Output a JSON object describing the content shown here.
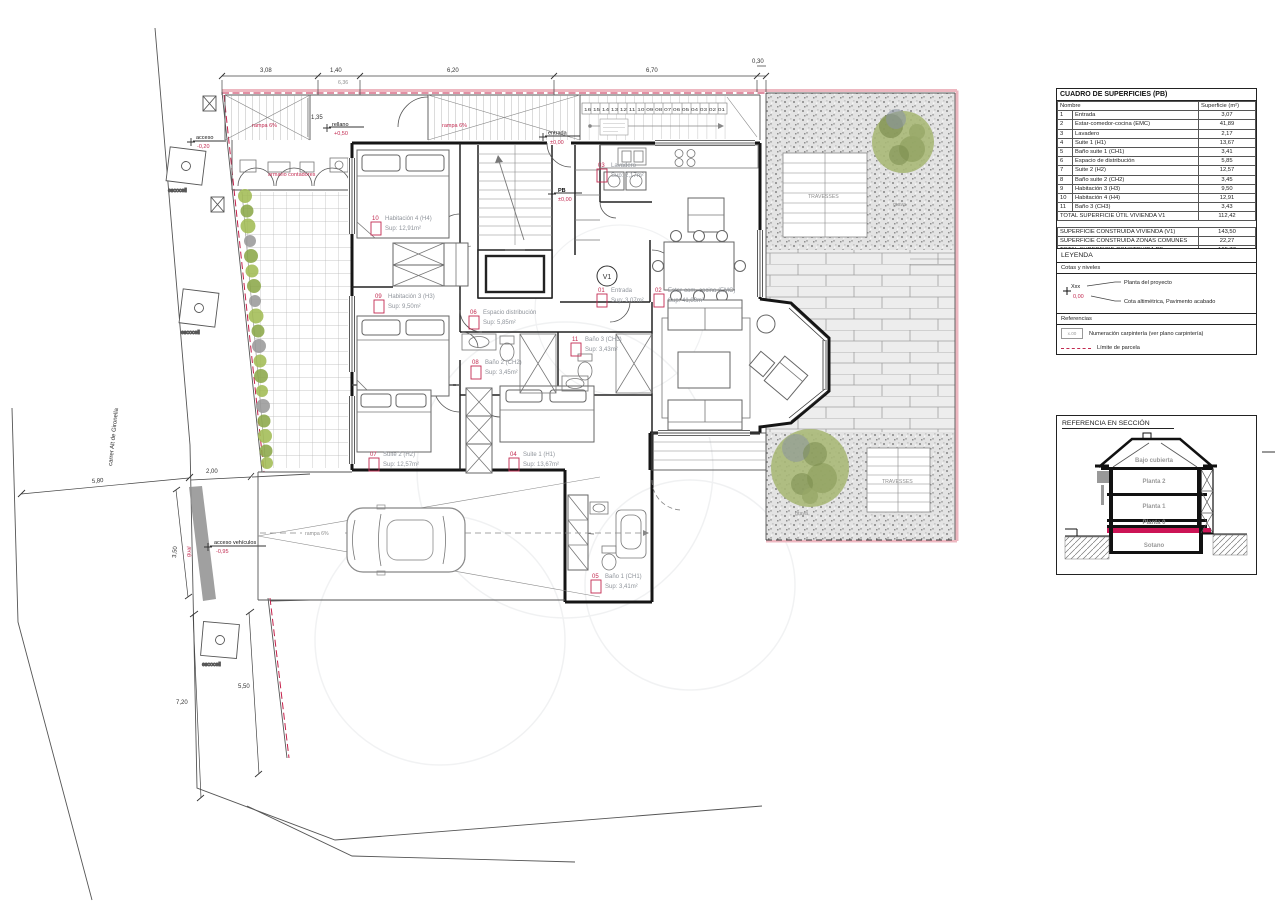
{
  "drawing": {
    "street_name": "carrer Alt de Gironella",
    "top_dims": {
      "d1": "3,08",
      "d2": "1,40",
      "d3": "6,20",
      "d4": "6,70",
      "d5": "0,30",
      "landing": "1,35",
      "offset": "6,36"
    },
    "site_dims": {
      "street_width": "5,80",
      "patio": "2,00",
      "gual_length": "3,50",
      "street_lower": "7,20",
      "kerb_lower": "5,50"
    },
    "levels": {
      "acceso": {
        "label": "acceso",
        "value": "-0,20"
      },
      "rellano": {
        "label": "rellano",
        "value": "+0,50"
      },
      "entrada": {
        "label": "entrada",
        "value": "±0,00"
      },
      "pb": {
        "label": "PB",
        "value": "±0,00"
      },
      "vehiculos": {
        "label": "acceso vehículos",
        "value": "-0,95"
      },
      "jardin": {
        "label": "jardín",
        "value": "+0,20"
      }
    },
    "notes": {
      "ramp_top_1": "rampa 6%",
      "ramp_top_2": "rampa 6%",
      "ramp_garage": "rampa 6%",
      "meter_cabinet": "armario contadores",
      "kerb": "gual",
      "deck_top": "TRAVESSES",
      "deck_bottom": "TRAVESSES",
      "gravel_top": "grava",
      "gravel_bottom": "grava",
      "tree_pit_1": "escocell",
      "tree_pit_2": "escocell",
      "tree_pit_3": "escocell",
      "stair_numbers": "16 15 14 13 12 11 10 09 08 07 06 05 04 03 02 01",
      "dwelling_tag": "V1"
    },
    "rooms": [
      {
        "num": "10",
        "name": "Habitación 4 (H4)",
        "area": "Sup: 12,91m²"
      },
      {
        "num": "09",
        "name": "Habitación 3 (H3)",
        "area": "Sup: 9,50m²"
      },
      {
        "num": "07",
        "name": "Suite 2 (H2)",
        "area": "Sup: 12,57m²"
      },
      {
        "num": "04",
        "name": "Suite 1 (H1)",
        "area": "Sup: 13,67m²"
      },
      {
        "num": "06",
        "name": "Espacio distribución",
        "area": "Sup: 5,85m²"
      },
      {
        "num": "08",
        "name": "Baño 2 (CH2)",
        "area": "Sup: 3,45m²"
      },
      {
        "num": "11",
        "name": "Baño 3 (CH3)",
        "area": "Sup: 3,43m²"
      },
      {
        "num": "05",
        "name": "Baño 1 (CH1)",
        "area": "Sup: 3,41m²"
      },
      {
        "num": "01",
        "name": "Entrada",
        "area": "Sup: 3,07m²"
      },
      {
        "num": "02",
        "name": "Estar-com.-cocina (EMC)",
        "area": "Sup: 41,89m²"
      },
      {
        "num": "03",
        "name": "Lavadero",
        "area": "Sup: 2,17m²"
      }
    ]
  },
  "surface_table": {
    "title": "CUADRO DE SUPERFICIES (PB)",
    "col_name": "Nombre",
    "col_area": "Superficie (m²)",
    "rows": [
      [
        "1",
        "Entrada",
        "3,07"
      ],
      [
        "2",
        "Estar-comedor-cocina (EMC)",
        "41,89"
      ],
      [
        "3",
        "Lavadero",
        "2,17"
      ],
      [
        "4",
        "Suite 1 (H1)",
        "13,67"
      ],
      [
        "5",
        "Baño suite 1 (CH1)",
        "3,41"
      ],
      [
        "6",
        "Espacio de distribución",
        "5,85"
      ],
      [
        "7",
        "Suite 2 (H2)",
        "12,57"
      ],
      [
        "8",
        "Baño suite 2 (CH2)",
        "3,45"
      ],
      [
        "9",
        "Habitación 3 (H3)",
        "9,50"
      ],
      [
        "10",
        "Habitación 4 (H4)",
        "12,91"
      ],
      [
        "11",
        "Baño 3 (CH3)",
        "3,43"
      ]
    ],
    "total_label": "TOTAL SUPERFICIE ÚTIL VIVIENDA V1",
    "total_value": "112,42",
    "built_rows": [
      [
        "SUPERFICIE CONSTRUIDA VIVIENDA (V1)",
        "143,50"
      ],
      [
        "SUPERFICIE CONSTRUIDA ZONAS COMUNES",
        "22,27"
      ],
      [
        "TOTAL SUPERFICIE CONSTRUIDA PB",
        "165,77"
      ]
    ]
  },
  "legend": {
    "title": "LEYENDA",
    "group_levels": "Cotas y niveles",
    "sym_plan": "Xxx",
    "sym_level": "0,00",
    "item_plan": "Planta del proyecto",
    "item_level": "Cota altimétrica, Pavimento acabado",
    "group_refs": "Referencias",
    "sym_ref": "x.00",
    "item_ref": "Numeración carpintería (ver plano carpintería)",
    "item_limit": "Límite de parcela"
  },
  "section_ref": {
    "title": "REFERENCIA EN SECCIÓN",
    "floors": [
      "Bajo cubierta",
      "Planta 2",
      "Planta 1",
      "Planta 0",
      "Sotano"
    ]
  }
}
